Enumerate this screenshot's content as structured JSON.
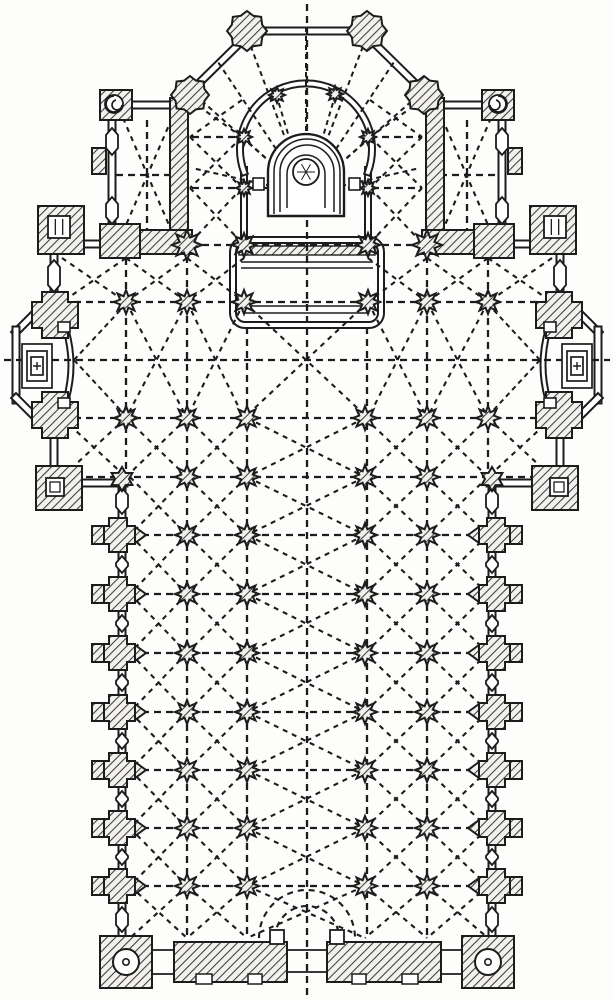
{
  "figure": {
    "type": "architectural-floor-plan",
    "subject": "engraved ground plan of a church: polygonal apse with interior colonnade and altar niche, flanking sacristy chapels, transept with apsidal side chapels, aisled nave with star-shaped compound piers and rib-vault lines, west front with corner stair turrets and three portals",
    "ink": "#1c1c1c",
    "paper": "#fdfdfb",
    "canvas": {
      "w": 614,
      "h": 1000
    }
  },
  "plan": {
    "dline_walls": [
      {
        "n": "apse-east-window",
        "d": "M252,31 H362",
        "w": 9
      },
      {
        "n": "apse-diagonal-left",
        "d": "M247,36 L192,90",
        "w": 9
      },
      {
        "n": "apse-diagonal-right",
        "d": "M367,36 L422,90",
        "w": 9
      },
      {
        "n": "chapel-left-north-window",
        "d": "M128,105 H172",
        "w": 9
      },
      {
        "n": "chapel-right-north-window",
        "d": "M442,105 H486",
        "w": 9
      },
      {
        "n": "chapel-left-west-wall",
        "d": "M112,116 V236",
        "w": 9
      },
      {
        "n": "chapel-right-east-wall",
        "d": "M502,116 V236",
        "w": 9
      },
      {
        "n": "transept-north-wall-left",
        "d": "M48,244 H106",
        "w": 9
      },
      {
        "n": "transept-north-wall-right",
        "d": "M508,244 H566",
        "w": 9
      },
      {
        "n": "transept-west-wall-a",
        "d": "M54,240 V300",
        "w": 9
      },
      {
        "n": "transept-west-wall-b",
        "d": "M54,430 V474",
        "w": 9
      },
      {
        "n": "transept-east-wall-a",
        "d": "M560,240 V300",
        "w": 9
      },
      {
        "n": "transept-east-wall-b",
        "d": "M560,430 V474",
        "w": 9
      },
      {
        "n": "chapel-apse-left-diag-top",
        "d": "M46,302 L16,332",
        "w": 9
      },
      {
        "n": "chapel-apse-left-face",
        "d": "M16,330 V400",
        "w": 9
      },
      {
        "n": "chapel-apse-left-diag-bottom",
        "d": "M16,398 L46,428",
        "w": 9
      },
      {
        "n": "chapel-apse-right-diag-top",
        "d": "M568,302 L598,332",
        "w": 9
      },
      {
        "n": "chapel-apse-right-face",
        "d": "M598,330 V400",
        "w": 9
      },
      {
        "n": "chapel-apse-right-diag-bottom",
        "d": "M598,398 L568,428",
        "w": 9
      },
      {
        "n": "transept-south-wall-left",
        "d": "M76,483 H124",
        "w": 9
      },
      {
        "n": "transept-south-wall-right",
        "d": "M490,483 H538",
        "w": 9
      },
      {
        "n": "nave-west-wall",
        "d": "M122,481 V938",
        "w": 9
      },
      {
        "n": "nave-east-wall",
        "d": "M492,481 V938",
        "w": 9
      },
      {
        "n": "choir-screen-left",
        "d": "M244,170 V242",
        "w": 8
      },
      {
        "n": "choir-screen-right",
        "d": "M368,170 V242",
        "w": 8
      },
      {
        "n": "apse-horseshoe-arc",
        "d": "M244,172 A66,66 0 1 1 368,172",
        "w": 8
      },
      {
        "n": "side-chapel-left-mouth-arch",
        "d": "M66,330 Q76,365 66,400",
        "w": 7
      },
      {
        "n": "side-chapel-right-mouth-arch",
        "d": "M548,330 Q538,365 548,400",
        "w": 7
      }
    ],
    "hatch_rects": [
      {
        "n": "chapel-left-east-wall",
        "r": [
          170,
          98,
          18,
          144
        ]
      },
      {
        "n": "chapel-right-west-wall",
        "r": [
          426,
          98,
          18,
          144
        ]
      },
      {
        "n": "chapel-left-stair-turret",
        "r": [
          100,
          90,
          32,
          30
        ]
      },
      {
        "n": "chapel-right-stair-turret",
        "r": [
          482,
          90,
          32,
          30
        ]
      },
      {
        "n": "chapel-left-south-wall",
        "r": [
          100,
          230,
          92,
          24
        ]
      },
      {
        "n": "chapel-left-corner-mass",
        "r": [
          100,
          224,
          40,
          34
        ]
      },
      {
        "n": "chapel-right-south-wall",
        "r": [
          422,
          230,
          92,
          24
        ]
      },
      {
        "n": "chapel-right-corner-mass",
        "r": [
          474,
          224,
          40,
          34
        ]
      },
      {
        "n": "transept-nw-turret",
        "r": [
          38,
          206,
          46,
          48
        ]
      },
      {
        "n": "transept-ne-turret",
        "r": [
          530,
          206,
          46,
          48
        ]
      },
      {
        "n": "transept-sw-turret",
        "r": [
          36,
          466,
          46,
          44
        ]
      },
      {
        "n": "transept-se-turret",
        "r": [
          532,
          466,
          46,
          44
        ]
      },
      {
        "n": "west-front-turret-left",
        "r": [
          100,
          936,
          52,
          52
        ]
      },
      {
        "n": "west-front-turret-right",
        "r": [
          462,
          936,
          52,
          52
        ]
      },
      {
        "n": "west-front-wall-left",
        "r": [
          174,
          942,
          113,
          40
        ]
      },
      {
        "n": "west-front-wall-right",
        "r": [
          327,
          942,
          114,
          40
        ]
      },
      {
        "n": "chapel-left-buttress-tab",
        "r": [
          92,
          148,
          14,
          26
        ]
      },
      {
        "n": "chapel-right-buttress-tab",
        "r": [
          508,
          148,
          14,
          26
        ]
      }
    ],
    "oct_piers": [
      [
        247,
        31,
        20
      ],
      [
        367,
        31,
        20
      ],
      [
        190,
        95,
        19
      ],
      [
        424,
        95,
        19
      ]
    ],
    "cross_piers": [
      [
        55,
        315,
        23,
        13
      ],
      [
        55,
        415,
        23,
        13
      ],
      [
        559,
        315,
        23,
        13
      ],
      [
        559,
        415,
        23,
        13
      ]
    ],
    "wall_piers": {
      "rows": [
        535,
        594,
        653,
        712,
        770,
        828,
        886
      ],
      "left": {
        "cx": 118,
        "tab": [
          92,
          12,
          18
        ],
        "apex_base": 135,
        "apex_tip": 146
      },
      "right": {
        "cx": 496,
        "tab": [
          510,
          12,
          18
        ],
        "apex_base": 479,
        "apex_tip": 468
      }
    },
    "hex_windows": [
      {
        "x": 122,
        "start": 484,
        "rows": [
          535,
          594,
          653,
          712,
          770,
          828,
          886
        ],
        "end": 936
      },
      {
        "x": 492,
        "start": 484,
        "rows": [
          535,
          594,
          653,
          712,
          770,
          828,
          886
        ],
        "end": 936
      },
      {
        "x": 54,
        "start": 256,
        "rows": [],
        "end": 296
      },
      {
        "x": 560,
        "start": 256,
        "rows": [],
        "end": 296
      },
      {
        "x": 112,
        "start": 124,
        "rows": [
          176
        ],
        "end": 228
      },
      {
        "x": 502,
        "start": 124,
        "rows": [
          176
        ],
        "end": 228
      }
    ],
    "stars_rows": [
      {
        "y": 245,
        "xs": [
          244,
          368
        ],
        "r": 12
      },
      {
        "y": 302,
        "xs": [
          126,
          187,
          244,
          368,
          427,
          488
        ],
        "r": 12
      },
      {
        "y": 418,
        "xs": [
          126,
          187,
          247,
          365,
          427,
          488
        ],
        "r": 12
      },
      {
        "y": 477,
        "xs": [
          187,
          247,
          365,
          427
        ],
        "r": 12
      }
    ],
    "nave_stars": {
      "rows": [
        535,
        594,
        653,
        712,
        770,
        828,
        886
      ],
      "xs": [
        187,
        247,
        365,
        427
      ],
      "r": 12
    },
    "stars_small": [
      [
        277,
        95
      ],
      [
        335,
        94
      ],
      [
        244,
        137
      ],
      [
        368,
        137
      ],
      [
        244,
        188
      ],
      [
        368,
        188
      ]
    ],
    "cross_stars": [
      [
        187,
        245
      ],
      [
        427,
        245
      ]
    ],
    "hex_piers": [
      [
        122,
        479
      ],
      [
        492,
        479
      ]
    ],
    "dashes": {
      "v": [
        [
          307,
          4,
          996
        ],
        [
          187,
          256,
          936
        ],
        [
          427,
          256,
          936
        ],
        [
          126,
          258,
          475
        ],
        [
          488,
          258,
          475
        ],
        [
          247,
          327,
          936
        ],
        [
          367,
          327,
          936
        ],
        [
          147,
          120,
          230
        ],
        [
          467,
          120,
          230
        ]
      ],
      "h": [
        [
          137,
          192,
          242
        ],
        [
          137,
          370,
          422
        ],
        [
          188,
          192,
          422
        ],
        [
          245,
          190,
          424
        ],
        [
          302,
          62,
          552
        ],
        [
          360,
          4,
          610
        ],
        [
          418,
          62,
          552
        ],
        [
          477,
          62,
          552
        ],
        [
          175,
          116,
          186
        ],
        [
          175,
          428,
          498
        ]
      ],
      "nave_rows": [
        535,
        594,
        653,
        712,
        770,
        828,
        886
      ],
      "nave_row_span": [
        130,
        488
      ]
    },
    "bays": {
      "fixed": [
        [
          62,
          258,
          126,
          302
        ],
        [
          126,
          258,
          187,
          302
        ],
        [
          187,
          258,
          244,
          302
        ],
        [
          368,
          258,
          427,
          302
        ],
        [
          427,
          258,
          488,
          302
        ],
        [
          488,
          258,
          552,
          302
        ],
        [
          126,
          302,
          187,
          418
        ],
        [
          187,
          302,
          244,
          418
        ],
        [
          244,
          302,
          368,
          418
        ],
        [
          368,
          302,
          427,
          418
        ],
        [
          427,
          302,
          488,
          418
        ],
        [
          62,
          418,
          126,
          477
        ],
        [
          126,
          418,
          187,
          477
        ],
        [
          187,
          418,
          247,
          477
        ],
        [
          247,
          418,
          365,
          477
        ],
        [
          365,
          418,
          427,
          477
        ],
        [
          427,
          418,
          488,
          477
        ],
        [
          488,
          418,
          552,
          477
        ],
        [
          190,
          100,
          242,
          137
        ],
        [
          190,
          137,
          242,
          188
        ],
        [
          190,
          188,
          242,
          243
        ],
        [
          370,
          100,
          422,
          137
        ],
        [
          370,
          137,
          422,
          188
        ],
        [
          370,
          188,
          422,
          243
        ],
        [
          123,
          118,
          172,
          232
        ],
        [
          442,
          118,
          491,
          232
        ]
      ],
      "nave_rowbands": [
        [
          477,
          535
        ],
        [
          535,
          594
        ],
        [
          594,
          653
        ],
        [
          653,
          712
        ],
        [
          712,
          770
        ],
        [
          770,
          828
        ],
        [
          828,
          886
        ],
        [
          886,
          938
        ]
      ],
      "nave_colbands": [
        [
          130,
          187
        ],
        [
          187,
          247
        ],
        [
          247,
          365
        ],
        [
          365,
          427
        ],
        [
          427,
          488
        ]
      ]
    },
    "fans": {
      "apse": {
        "c": [
          306,
          194
        ],
        "targets": [
          [
            192,
            92
          ],
          [
            218,
            62
          ],
          [
            247,
            36
          ],
          [
            306,
            26
          ],
          [
            367,
            36
          ],
          [
            394,
            62
          ],
          [
            422,
            92
          ],
          [
            277,
            97
          ],
          [
            335,
            96
          ],
          [
            244,
            139
          ],
          [
            368,
            139
          ],
          [
            192,
            168
          ],
          [
            420,
            168
          ]
        ]
      },
      "chapels": [
        {
          "c": [
            74,
            360
          ],
          "targets": [
            [
              126,
              304
            ],
            [
              126,
              416
            ]
          ]
        },
        {
          "c": [
            540,
            360
          ],
          "targets": [
            [
              488,
              304
            ],
            [
              488,
              416
            ]
          ]
        }
      ]
    },
    "enclosure": {
      "outline": {
        "x": 233,
        "y": 240,
        "w": 148,
        "h": 85,
        "r": 12
      },
      "strip": [
        239,
        246,
        136,
        9
      ],
      "lines": [
        [
          241,
          262,
          373
        ],
        [
          241,
          268,
          373
        ],
        [
          243,
          306,
          371
        ],
        [
          245,
          313,
          369
        ]
      ]
    },
    "niche": {
      "shells": [
        "M268,216 V172 A38,38 0 0 1 344,172 V216 Z",
        "M274,214 V172 A32,32 0 0 1 340,172 V214",
        "M280,212 V172 A26,26 0 0 1 334,172 V212",
        "M287,208 V174 A19,19 0 0 1 325,174 V208"
      ],
      "circle": [
        306,
        172,
        13
      ],
      "tabs": [
        [
          253,
          178,
          11,
          12
        ],
        [
          349,
          178,
          11,
          12
        ]
      ]
    },
    "altars": [
      {
        "rects": [
          [
            22,
            344,
            30,
            44
          ],
          [
            27,
            351,
            20,
            30
          ],
          [
            31,
            357,
            12,
            18
          ]
        ],
        "cross": [
          37,
          366
        ]
      },
      {
        "rects": [
          [
            562,
            344,
            30,
            44
          ],
          [
            567,
            351,
            20,
            30
          ],
          [
            571,
            357,
            12,
            18
          ]
        ],
        "cross": [
          577,
          366
        ]
      }
    ],
    "mouth_tabs": [
      [
        58,
        322,
        12,
        10
      ],
      [
        58,
        398,
        12,
        10
      ],
      [
        544,
        322,
        12,
        10
      ],
      [
        544,
        398,
        12,
        10
      ]
    ],
    "portal": {
      "arcs": [
        "M259,938 A48,48 0 0 1 355,938",
        "M275,938 A32,32 0 0 1 339,938"
      ],
      "blocks": [
        [
          270,
          930,
          14,
          14
        ],
        [
          330,
          930,
          14,
          14
        ]
      ],
      "notches": [
        [
          196,
          974,
          16,
          10
        ],
        [
          248,
          974,
          14,
          10
        ],
        [
          352,
          974,
          14,
          10
        ],
        [
          402,
          974,
          16,
          10
        ]
      ],
      "door_lines": [
        [
          152,
          950,
          174
        ],
        [
          152,
          974,
          174
        ],
        [
          441,
          950,
          463
        ],
        [
          441,
          974,
          463
        ],
        [
          287,
          950,
          327
        ],
        [
          287,
          972,
          327
        ]
      ]
    },
    "turret_circles": [
      [
        126,
        962,
        13
      ],
      [
        488,
        962,
        13
      ]
    ],
    "stair_squares": [
      {
        "r": [
          48,
          216,
          22,
          22
        ],
        "bars": true
      },
      {
        "r": [
          544,
          216,
          22,
          22
        ],
        "bars": true
      },
      {
        "r": [
          46,
          478,
          18,
          18
        ],
        "inner": true
      },
      {
        "r": [
          550,
          478,
          18,
          18
        ],
        "inner": true
      }
    ],
    "spirals": [
      {
        "c": [
          114,
          104,
          9
        ],
        "hook": "M114,96 a8,8 0 1 0 8,9 a5,5 0 1 1 -6,-5"
      },
      {
        "c": [
          498,
          104,
          9
        ],
        "hook": "M498,96 a8,8 0 1 1 -8,9 a5,5 0 1 0 6,-5"
      }
    ]
  }
}
